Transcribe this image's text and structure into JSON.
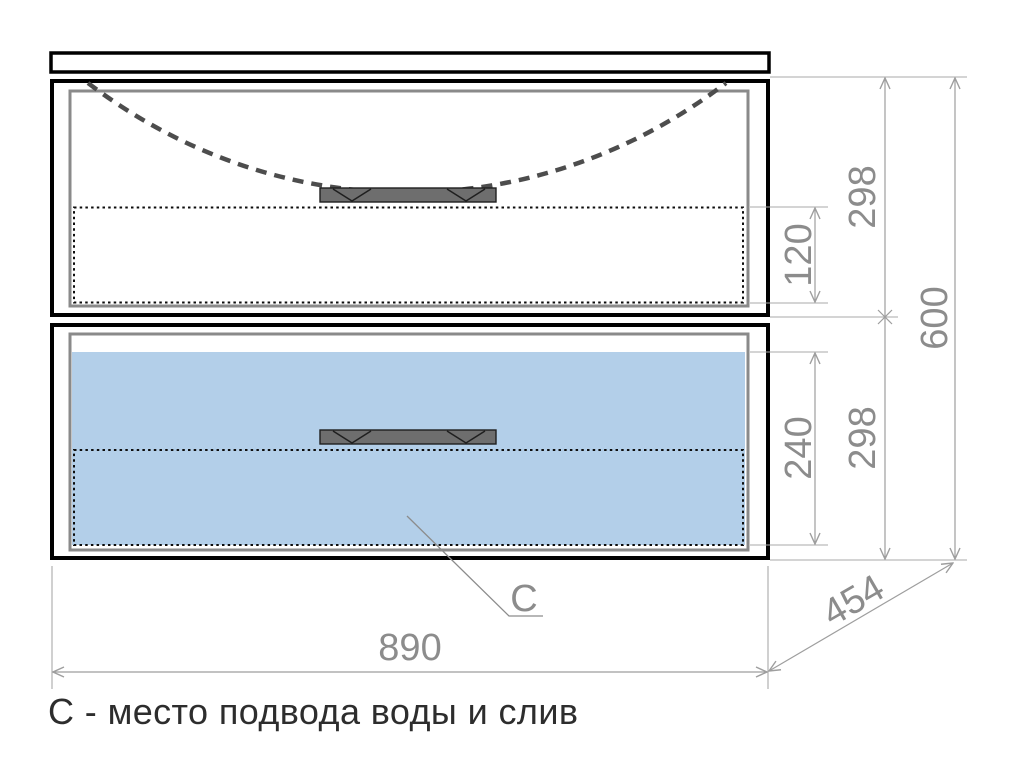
{
  "caption": "С - место подвода воды и слив",
  "dimensions": {
    "overall_width": "890",
    "overall_height": "600",
    "overall_depth": "454",
    "top_drawer_front_height": "298",
    "bottom_drawer_front_height": "298",
    "top_drawer_inner_depth": "120",
    "bottom_drawer_inner_depth": "240"
  },
  "marker": {
    "label": "С"
  },
  "colors": {
    "background": "#ffffff",
    "frame": "#000000",
    "inner_frame": "#8a8a8a",
    "drawer_highlight_fill": "#b3cfe9",
    "handle_fill": "#6e6e6e",
    "sink_outline": "#4d4d4d",
    "dimension_line": "#9e9e9e",
    "dimension_text": "#8c8c8c",
    "caption_text": "#2d2d2d"
  }
}
